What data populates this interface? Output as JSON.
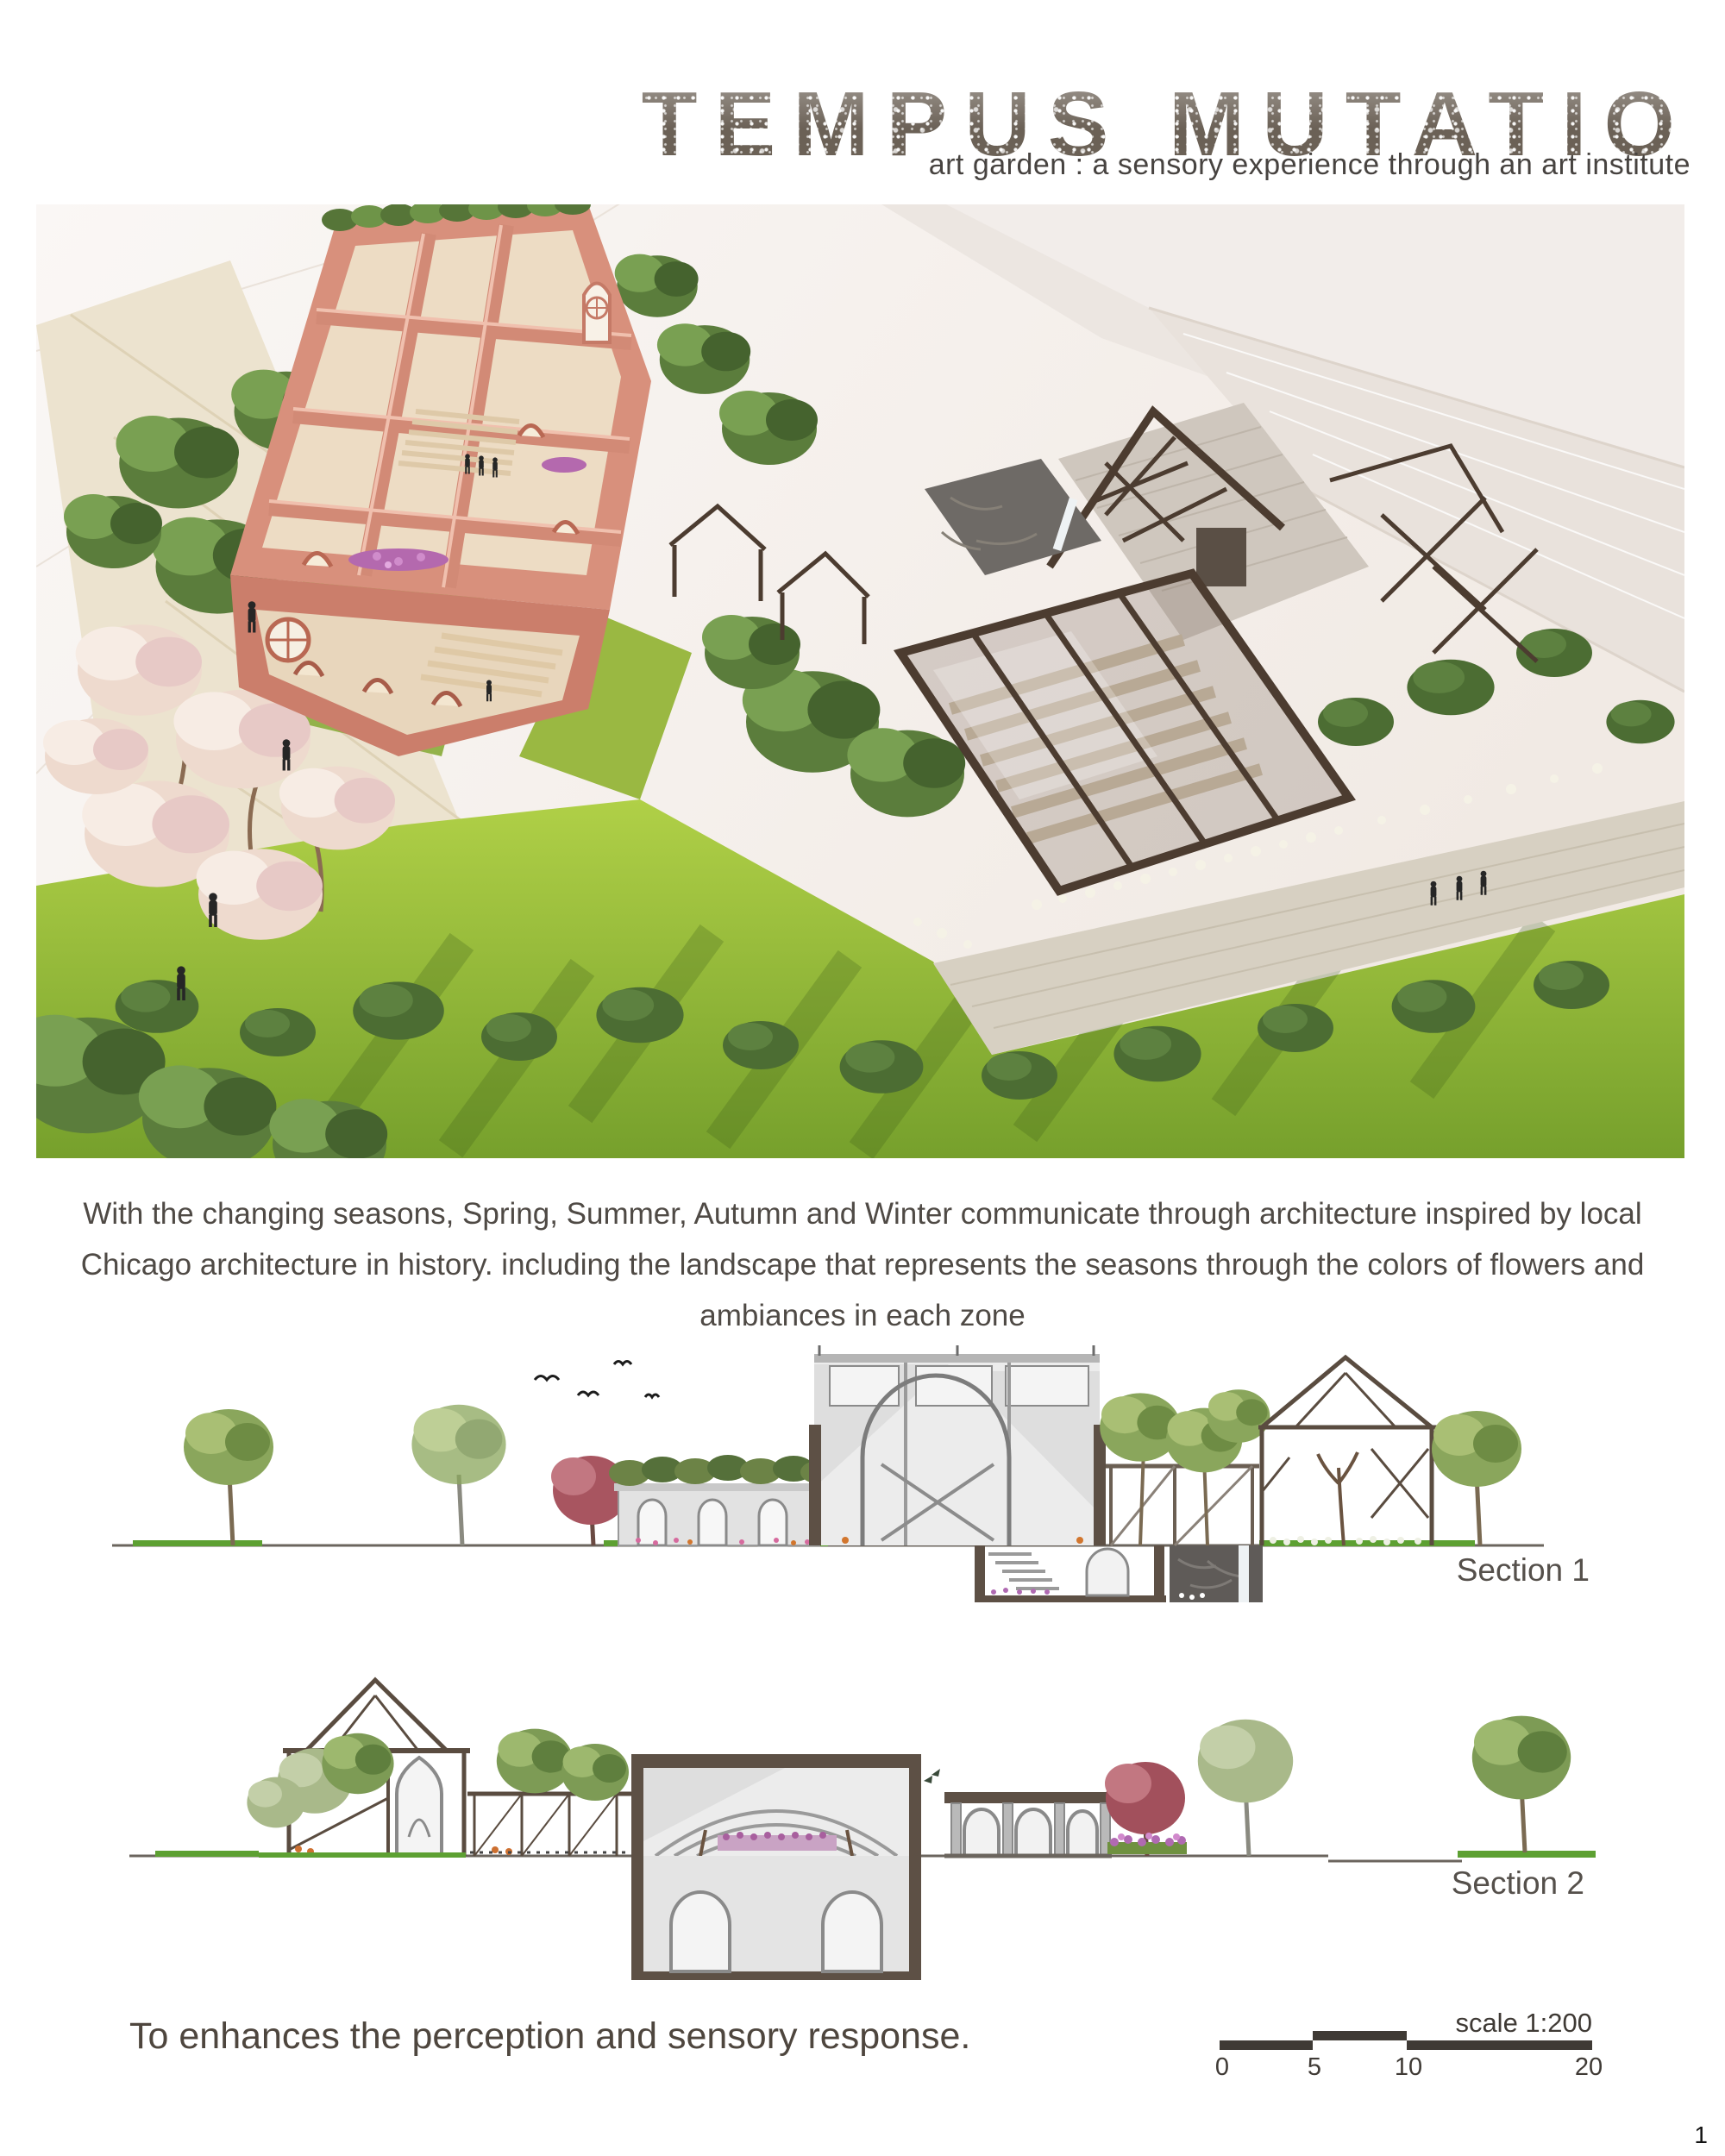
{
  "page": {
    "background": "#ffffff",
    "page_number": "1"
  },
  "header": {
    "title": "TEMPUS MUTATIO",
    "subtitle": "art garden : a sensory experience through an art institute",
    "title_color": "#6b6156",
    "text_color": "#4f4a45"
  },
  "description": {
    "lines": [
      "With the changing seasons, Spring, Summer, Autumn and Winter communicate through architecture inspired by local",
      "Chicago architecture in history. including the landscape that represents the seasons through the colors of flowers and",
      "ambiances in each zone"
    ]
  },
  "sections": [
    {
      "label": "Section 1"
    },
    {
      "label": "Section 2"
    }
  ],
  "footer": {
    "statement": "To enhances the perception and sensory response.",
    "scale_label": "scale 1:200",
    "scale_ticks": [
      "0",
      "5",
      "10",
      "20"
    ]
  },
  "palette": {
    "brick": "#d8907c",
    "lawn": "#9cc23b",
    "foliage": "#5b7d3c",
    "glass_frame": "#4c3c30",
    "stone": "#cfc7be",
    "blossom": "#eedace",
    "label_color": "#55504b"
  }
}
